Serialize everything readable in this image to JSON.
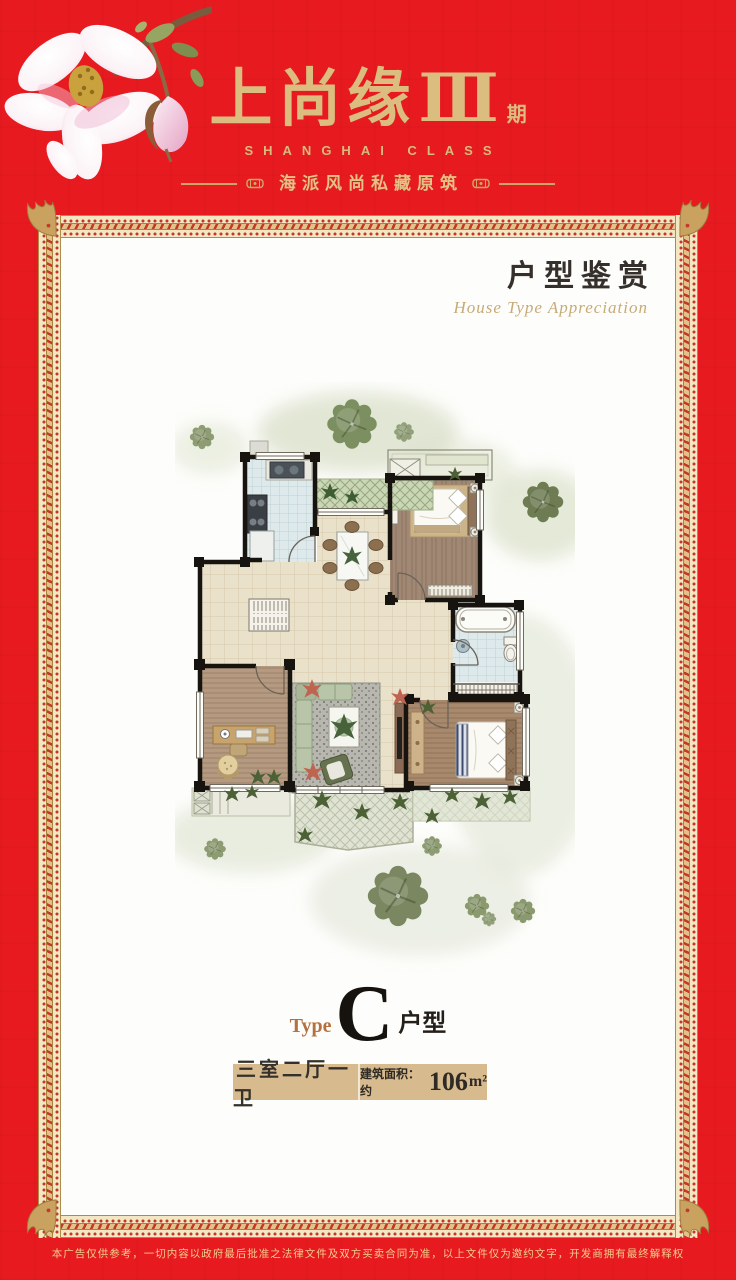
{
  "page": {
    "bg_color": "#e71a20",
    "panel_color": "#fdfdfb",
    "gold": "#d9bb7e",
    "frame_gold": "#c9a25f"
  },
  "header": {
    "title_cn": "上尚缘",
    "title_numeral": "Ⅲ",
    "title_suffix": "期",
    "title_en": "SHANGHAI CLASS",
    "tagline": "海派风尚私藏原筑"
  },
  "section": {
    "title": "户型鉴赏",
    "subtitle": "House Type Appreciation"
  },
  "type_block": {
    "label": "Type",
    "letter": "C",
    "suffix": "户型"
  },
  "spec_bar": {
    "rooms": "三室二厅一卫",
    "area_prefix": "建筑面积：约",
    "area_number": "106",
    "area_unit": "m²",
    "bg_color": "#d7ba8e"
  },
  "footer": {
    "disclaimer": "本广告仅供参考，一切内容以政府最后批准之法律文件及双方买卖合同为准，以上文件仅为邀约文字，开发商拥有最终解释权"
  }
}
